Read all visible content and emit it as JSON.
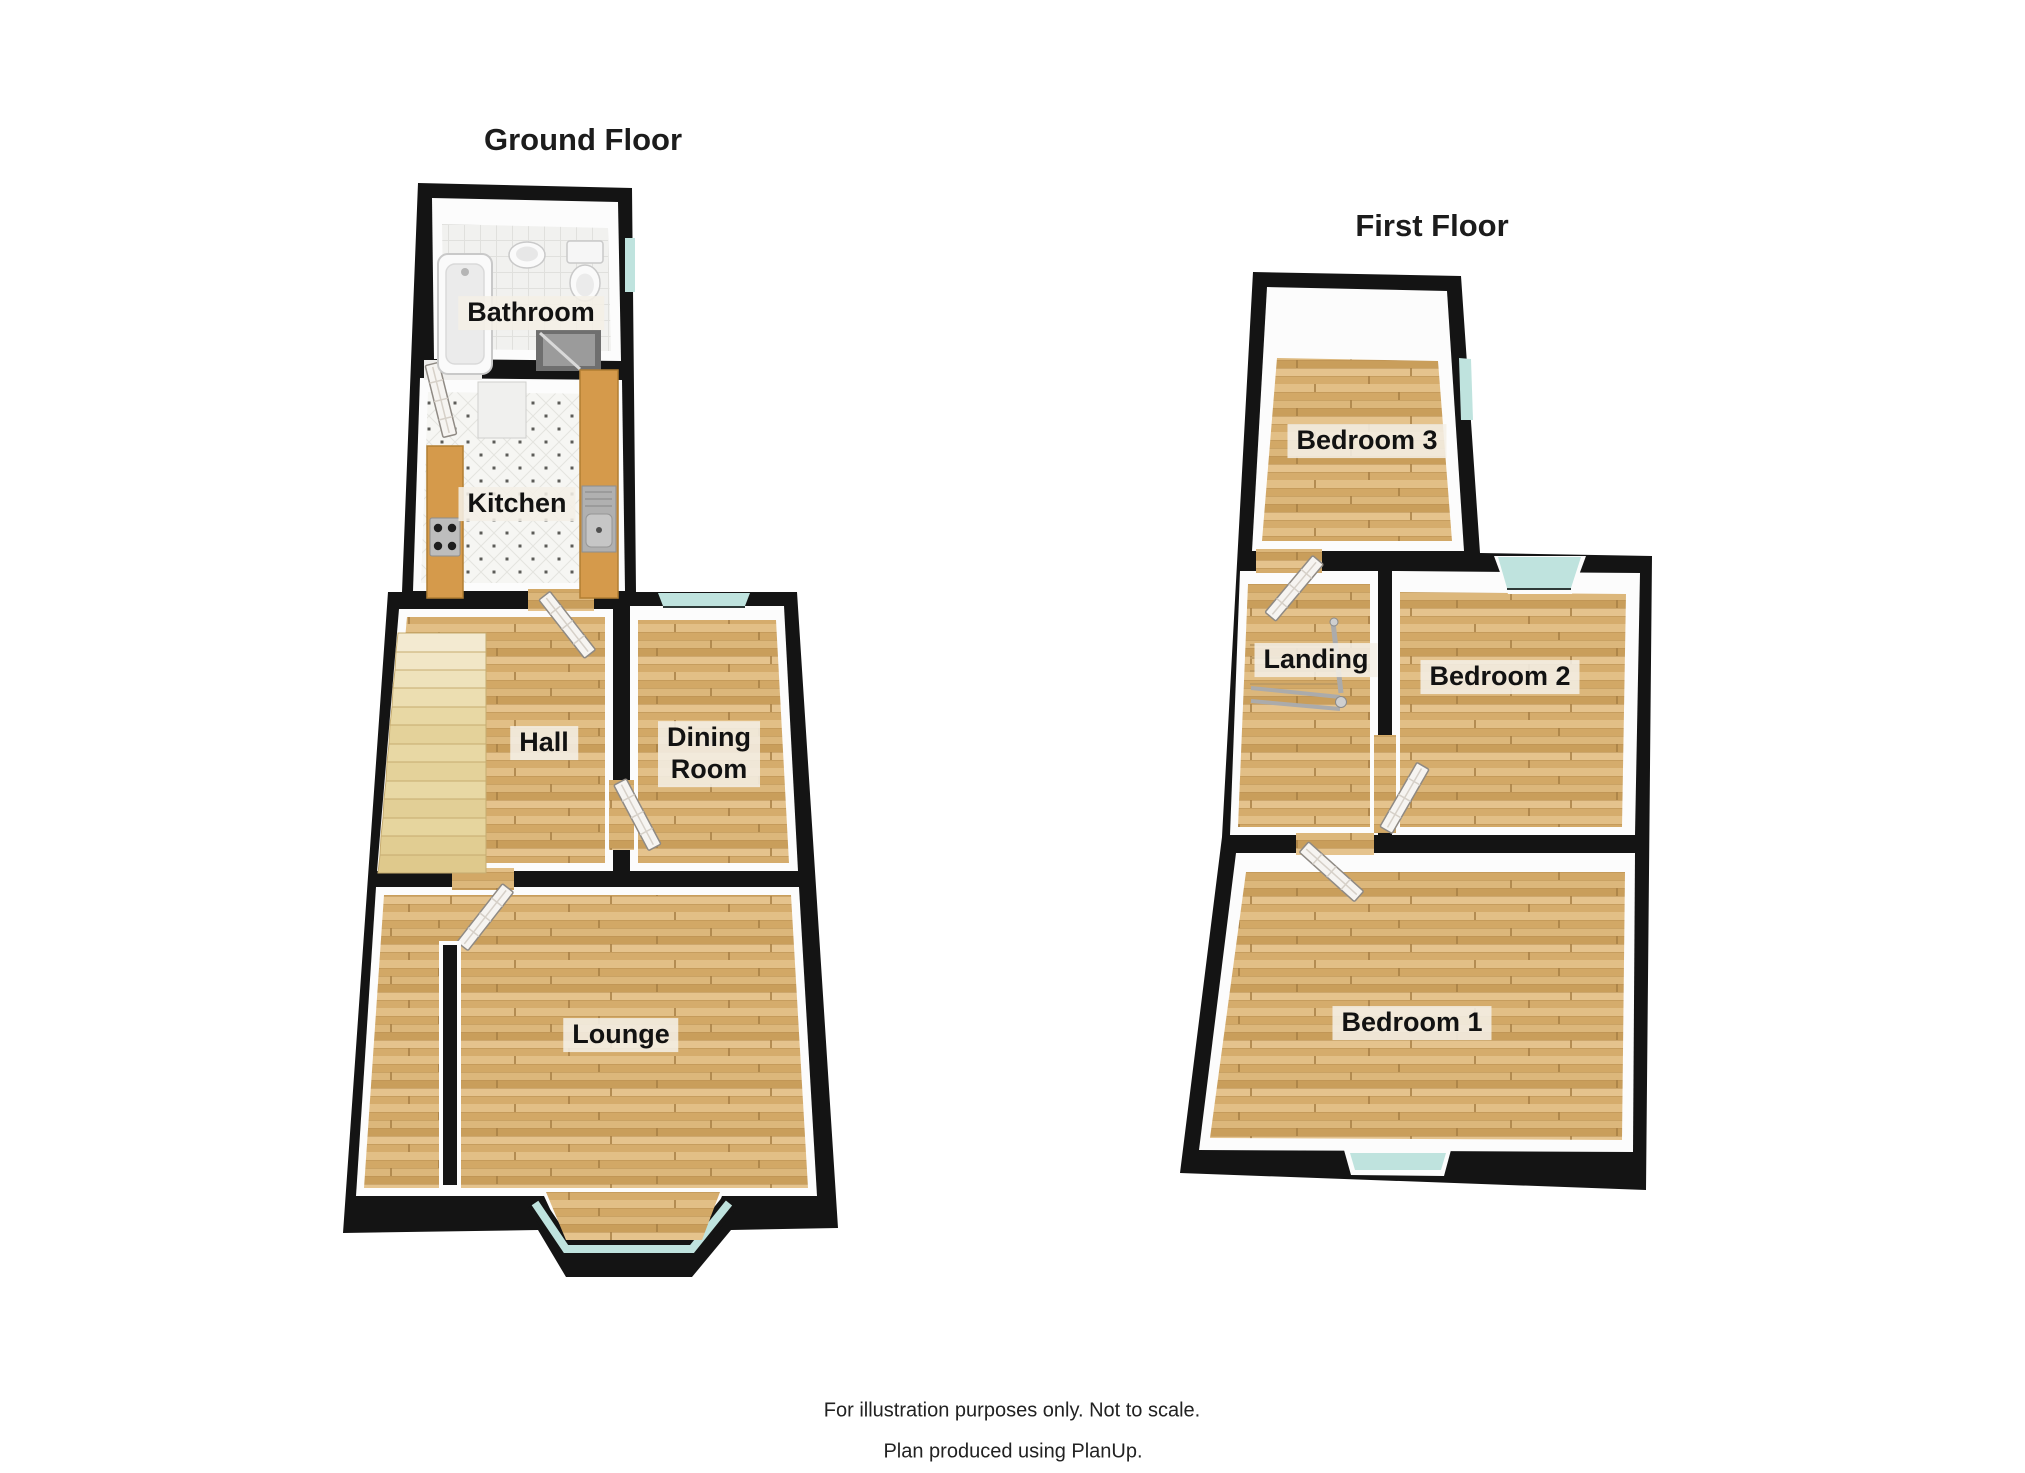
{
  "document": {
    "background_color": "#ffffff"
  },
  "colors": {
    "wall": "#141414",
    "wood_floor": "#d9b277",
    "glass": "#bfe3de",
    "stairs": "#e8d8a4",
    "counter": "#d59a4b",
    "label_bg": "rgba(244,239,230,0.88)",
    "label_text": "#121212"
  },
  "ground_floor": {
    "title": "Ground Floor",
    "rooms": {
      "bathroom": "Bathroom",
      "kitchen": "Kitchen",
      "hall": "Hall",
      "dining_room": "Dining\nRoom",
      "lounge": "Lounge"
    }
  },
  "first_floor": {
    "title": "First Floor",
    "rooms": {
      "bedroom3": "Bedroom 3",
      "landing": "Landing",
      "bedroom2": "Bedroom 2",
      "bedroom1": "Bedroom 1"
    }
  },
  "footer": {
    "disclaimer": "For illustration purposes only. Not to scale.",
    "credit": "Plan produced using PlanUp."
  }
}
